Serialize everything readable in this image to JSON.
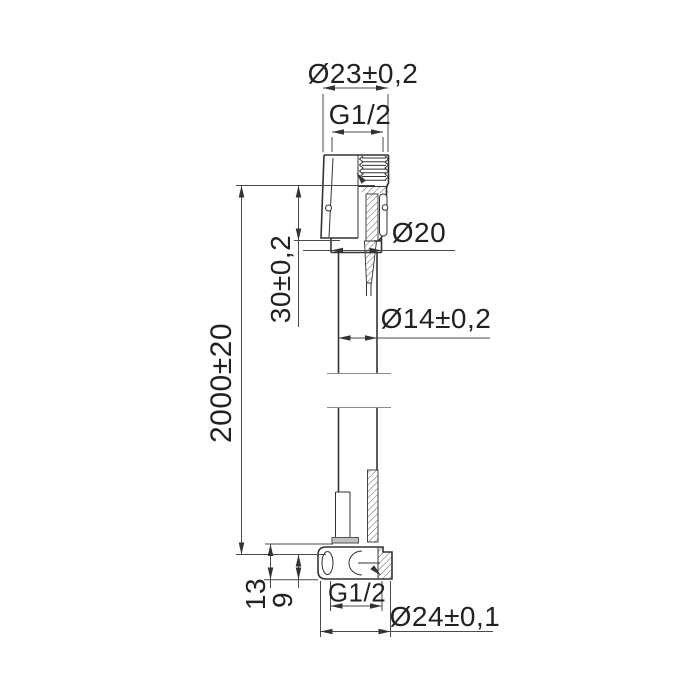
{
  "drawing": {
    "type": "technical-drawing-shower-hose",
    "colors": {
      "line": "#333333",
      "thin_line": "#4a4a4a",
      "text": "#222222",
      "washer_fill": "#c0c0c0",
      "background": "#ffffff"
    },
    "dimensions": {
      "top_outer_diameter": "Ø23±0,2",
      "top_thread": "G1/2",
      "cone_diameter": "Ø20",
      "hose_diameter": "Ø14±0,2",
      "fitting_length": "30±0,2",
      "hose_length": "2000±20",
      "bottom_fitting_height": "13",
      "bottom_seat_height": "9",
      "bottom_thread": "G1/2",
      "bottom_outer_diameter": "Ø24±0,1"
    }
  }
}
